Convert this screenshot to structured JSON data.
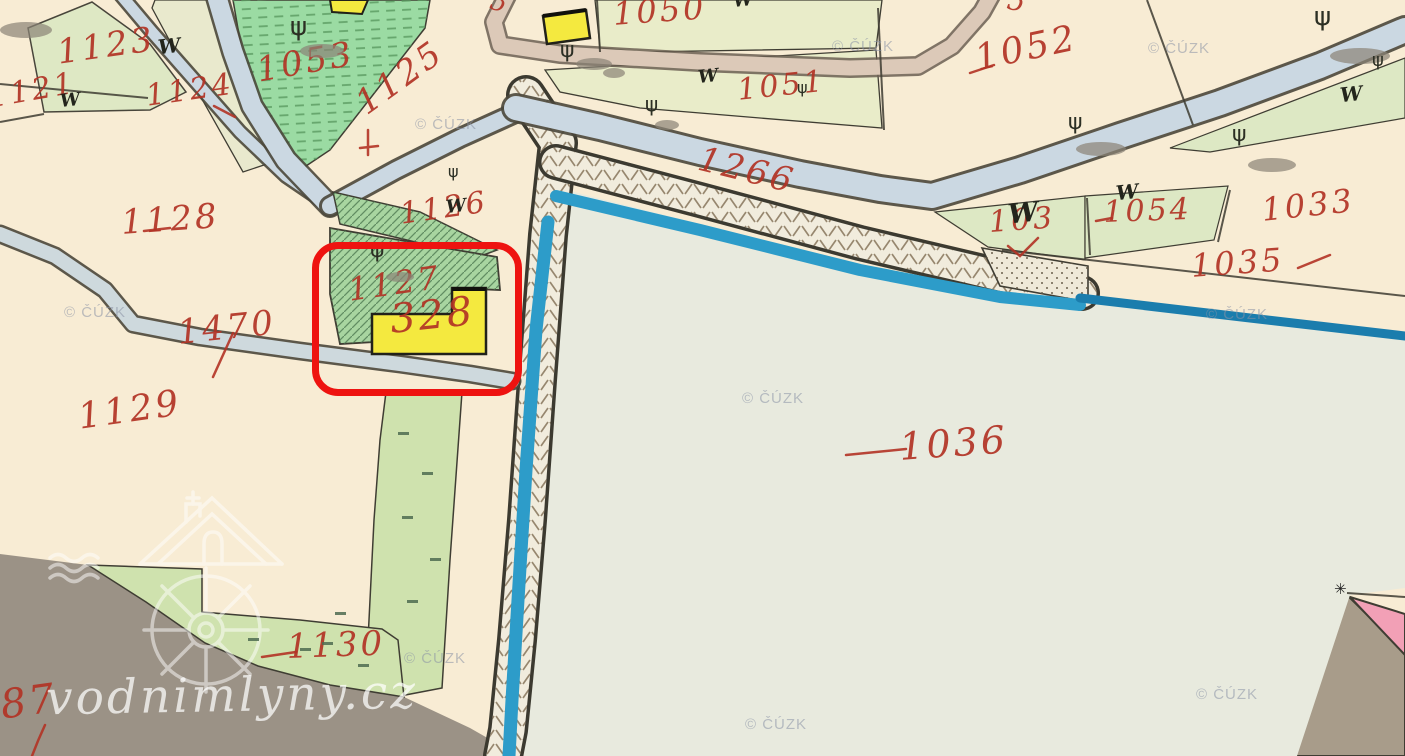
{
  "map": {
    "watermark_brand": "vodnimlyny.cz",
    "copyright_text": "© ČÚZK",
    "copyright_positions": [
      [
        832,
        38
      ],
      [
        1148,
        40
      ],
      [
        415,
        116
      ],
      [
        64,
        304
      ],
      [
        1206,
        306
      ],
      [
        742,
        390
      ],
      [
        404,
        650
      ],
      [
        745,
        716
      ],
      [
        1196,
        686
      ]
    ],
    "parcel_labels": [
      {
        "id": "1123",
        "text": "1123",
        "x": 55,
        "y": 36,
        "size": 34,
        "rot": -8
      },
      {
        "id": "1121",
        "text": "1121",
        "x": -14,
        "y": 84,
        "size": 30,
        "rot": -10
      },
      {
        "id": "1124",
        "text": "1124",
        "x": 144,
        "y": 82,
        "size": 30,
        "rot": -8
      },
      {
        "id": "1053",
        "text": "1053",
        "x": 254,
        "y": 54,
        "size": 34,
        "rot": -10
      },
      {
        "id": "1125",
        "text": "1125",
        "x": 350,
        "y": 93,
        "size": 34,
        "rot": -36
      },
      {
        "id": "1050",
        "text": "1050",
        "x": 612,
        "y": -2,
        "size": 32,
        "rot": -4
      },
      {
        "id": "1051",
        "text": "1051",
        "x": 736,
        "y": 76,
        "size": 30,
        "rot": -6
      },
      {
        "id": "1052",
        "text": "1052",
        "x": 972,
        "y": 42,
        "size": 36,
        "rot": -12
      },
      {
        "id": "1266",
        "text": "1266",
        "x": 703,
        "y": 142,
        "size": 34,
        "rot": 14
      },
      {
        "id": "1128",
        "text": "1128",
        "x": 120,
        "y": 206,
        "size": 34,
        "rot": -4
      },
      {
        "id": "1126",
        "text": "1126",
        "x": 398,
        "y": 200,
        "size": 30,
        "rot": -8
      },
      {
        "id": "1127",
        "text": "1127",
        "x": 346,
        "y": 274,
        "size": 32,
        "rot": -8
      },
      {
        "id": "328",
        "text": "328",
        "x": 388,
        "y": 300,
        "size": 40,
        "rot": -6
      },
      {
        "id": "1470",
        "text": "1470",
        "x": 176,
        "y": 316,
        "size": 34,
        "rot": -6
      },
      {
        "id": "1129",
        "text": "1129",
        "x": 76,
        "y": 400,
        "size": 36,
        "rot": -8
      },
      {
        "id": "1036",
        "text": "1036",
        "x": 898,
        "y": 428,
        "size": 38,
        "rot": -4
      },
      {
        "id": "1037",
        "text": "103",
        "x": 988,
        "y": 208,
        "size": 30,
        "rot": -4
      },
      {
        "id": "1054",
        "text": "1054",
        "x": 1103,
        "y": 198,
        "size": 30,
        "rot": -2
      },
      {
        "id": "1033",
        "text": "1033",
        "x": 1260,
        "y": 194,
        "size": 32,
        "rot": -6
      },
      {
        "id": "1035",
        "text": "1035",
        "x": 1190,
        "y": 250,
        "size": 32,
        "rot": -4
      },
      {
        "id": "1130",
        "text": "1130",
        "x": 286,
        "y": 630,
        "size": 34,
        "rot": -2
      },
      {
        "id": "87",
        "text": "87",
        "x": -2,
        "y": 686,
        "size": 40,
        "rot": -8
      },
      {
        "id": "edge-a",
        "text": "5",
        "x": 494,
        "y": -12,
        "size": 26,
        "rot": 15
      },
      {
        "id": "edge-b",
        "text": "5",
        "x": 1010,
        "y": -14,
        "size": 28,
        "rot": 10
      }
    ],
    "symbols": {
      "meadow_glyph": "W",
      "meadow_positions": [
        [
          158,
          36,
          20
        ],
        [
          60,
          92,
          18
        ],
        [
          733,
          -8,
          18
        ],
        [
          698,
          68,
          18
        ],
        [
          446,
          198,
          18
        ],
        [
          1116,
          182,
          20
        ],
        [
          1340,
          84,
          20
        ],
        [
          1008,
          200,
          27
        ]
      ],
      "tree_glyph": "ψ",
      "tree_positions": [
        [
          290,
          14,
          26
        ],
        [
          560,
          40,
          22
        ],
        [
          645,
          94,
          20
        ],
        [
          1314,
          4,
          26
        ],
        [
          1068,
          112,
          22
        ],
        [
          1232,
          124,
          22
        ],
        [
          370,
          240,
          22
        ],
        [
          1372,
          52,
          18
        ],
        [
          448,
          164,
          16
        ],
        [
          797,
          80,
          16
        ]
      ],
      "tree_shadows": [
        [
          300,
          44,
          44,
          14
        ],
        [
          576,
          58,
          36,
          12
        ],
        [
          655,
          120,
          24,
          10
        ],
        [
          1330,
          48,
          60,
          16
        ],
        [
          1076,
          142,
          50,
          14
        ],
        [
          1248,
          158,
          48,
          14
        ],
        [
          386,
          272,
          28,
          10
        ],
        [
          603,
          68,
          22,
          10
        ],
        [
          0,
          22,
          52,
          16
        ]
      ],
      "grass_dashes": [
        [
          398,
          432
        ],
        [
          422,
          472
        ],
        [
          402,
          516
        ],
        [
          430,
          558
        ],
        [
          407,
          600
        ],
        [
          322,
          642
        ],
        [
          358,
          664
        ],
        [
          335,
          612
        ],
        [
          300,
          648
        ],
        [
          248,
          638
        ]
      ],
      "star_glyph": "✳"
    },
    "highlight": {
      "color": "#ee1310",
      "x": 312,
      "y": 242,
      "w": 196,
      "h": 140
    },
    "colors": {
      "paper_cream": "#f8ecd4",
      "pale_green": "#dde8c4",
      "bottom_green": "#cfe2ae",
      "bright_green": "#9bdba3",
      "hatch_green": "#a8d5a0",
      "pond_pale": "#e8eade",
      "pond_edge_bright": "#2d9cc9",
      "pond_edge_dark": "#1b7dad",
      "stream_blue": "#cbd8e2",
      "road_tan": "#dcc9b8",
      "road_gray": "#ced9dd",
      "dam_fill": "#f1ecdd",
      "gray_area": "#9b9286",
      "pink_building": "#f2a0b6",
      "yellow_building": "#f4e93f",
      "label_red": "#b23325",
      "highlight_red": "#ee1310"
    }
  }
}
